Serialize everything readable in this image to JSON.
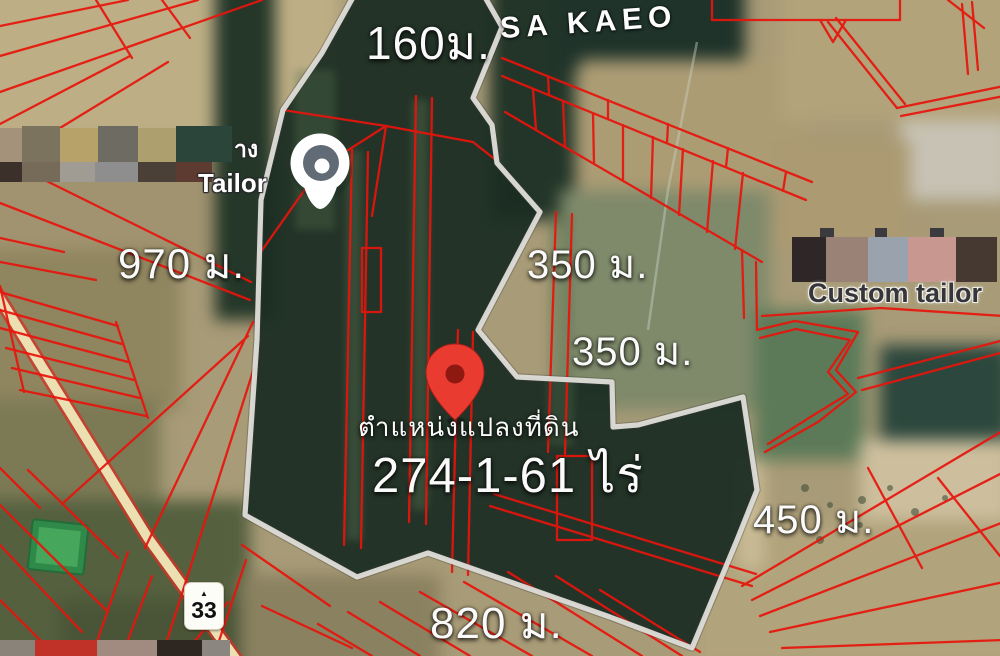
{
  "map": {
    "province_label": "SA KAEO",
    "route_shield": "33",
    "poi": {
      "tailor": "Tailor",
      "tailor_partial": "าง",
      "custom_tailor": "Custom tailor"
    },
    "measurements": {
      "top": "160ม.",
      "west": "970 ม.",
      "east_upper": "350 ม.",
      "east_mid": "350 ม.",
      "east_lower": "450 ม.",
      "south": "820 ม."
    },
    "plot": {
      "marker_caption": "ตำแหน่งแปลงที่ดิน",
      "area": "274-1-61 ไร่"
    },
    "icons": {
      "shield_emblem": "▲"
    },
    "colors": {
      "parcel_lines": "#e8140c",
      "plot_boundary": "#dcdbd6",
      "location_pin": "#ea3b30",
      "place_pin_inner": "#606b76",
      "forest": "#1b2d23",
      "field": "#a89b77",
      "road": "#ecdfb2",
      "pond": "#2f8a4a"
    }
  }
}
